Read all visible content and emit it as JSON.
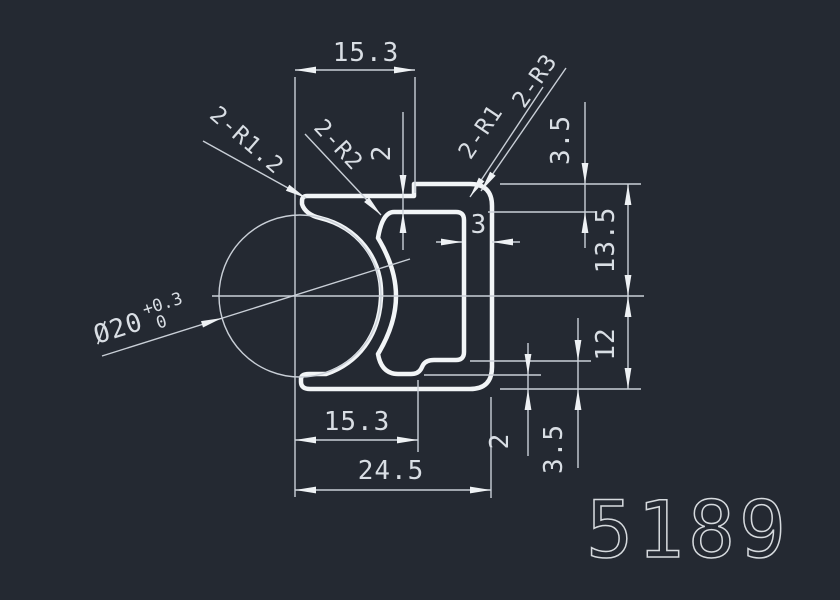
{
  "drawing_type": "CAD extrusion profile cross-section",
  "part_number": "5189",
  "colors": {
    "background": "#242932",
    "profile_line": "#f2f5f7",
    "thin_line": "#c9cfd7",
    "text": "#d9dee4"
  },
  "dims": {
    "top_width": "15.3",
    "top_step": "2",
    "lip_thickness": "3.5",
    "upper_height": "13.5",
    "lower_height": "12",
    "wall_thickness": "3",
    "bottom_step": "2",
    "bottom_wall": "3.5",
    "bottom_inner_width": "15.3",
    "total_width": "24.5"
  },
  "radii": {
    "top_left": "2-R1.2",
    "inner_left": "2-R2",
    "inner_right": "2-R1",
    "outer_right": "2-R3"
  },
  "diameter": {
    "value": "Ø20",
    "tol_upper": "+0.3",
    "tol_lower": "0"
  }
}
